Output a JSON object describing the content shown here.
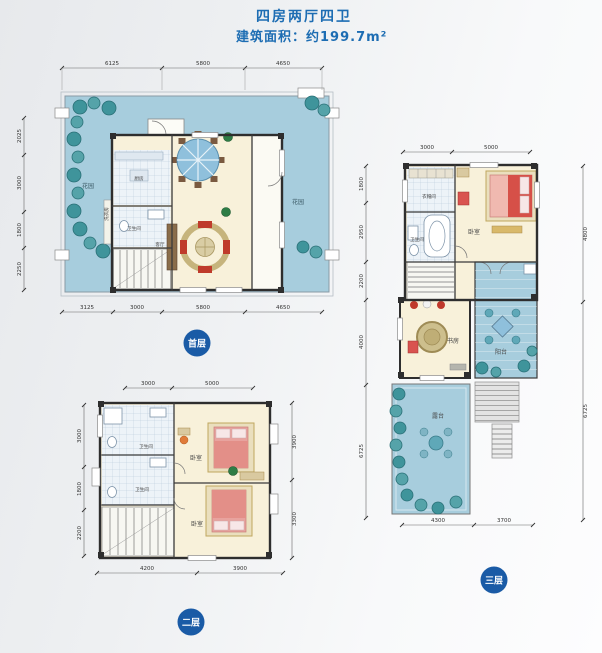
{
  "header": {
    "title": "四房两厅四卫",
    "subtitle": "建筑面积：约199.7m²"
  },
  "colors": {
    "accent_blue": "#1d6db3",
    "badge_blue": "#1a5ba6",
    "garden_blue": "#a7cddd",
    "tree_teal": "#3f949b",
    "interior_cream": "#f8f1da"
  },
  "floors": {
    "first": {
      "badge": "首层",
      "dims_top": [
        "6125",
        "5800",
        "4650"
      ],
      "dims_left": [
        "2025",
        "3000",
        "1800",
        "2250"
      ],
      "dims_bottom": [
        "3125",
        "3000",
        "5800",
        "4650"
      ],
      "rooms": {
        "garden_left": "花园",
        "garden_right": "花园",
        "kitchen": "厨房",
        "bath": "卫生间",
        "laundry": "洗衣房",
        "living": "客厅"
      }
    },
    "second": {
      "badge": "二层",
      "dims_top": [
        "3000",
        "5000"
      ],
      "dims_left": [
        "3000",
        "1800",
        "2200"
      ],
      "dims_right": [
        "3900",
        "3300"
      ],
      "dims_bottom": [
        "4200",
        "3900"
      ],
      "rooms": {
        "bath_top": "卫生间",
        "bath_bottom": "卫生间",
        "bedroom_top": "卧室",
        "bedroom_bottom": "卧室"
      }
    },
    "third": {
      "badge": "三层",
      "dims_top": [
        "3000",
        "5000"
      ],
      "dims_left": [
        "1800",
        "2950",
        "2200",
        "4000",
        "6725"
      ],
      "dims_right": [
        "4800",
        "6725"
      ],
      "dims_bottom": [
        "4300",
        "3700"
      ],
      "rooms": {
        "cloakroom": "衣帽间",
        "bath": "卫生间",
        "bedroom": "卧室",
        "balcony": "阳台",
        "study": "书房",
        "terrace": "露台"
      }
    }
  }
}
